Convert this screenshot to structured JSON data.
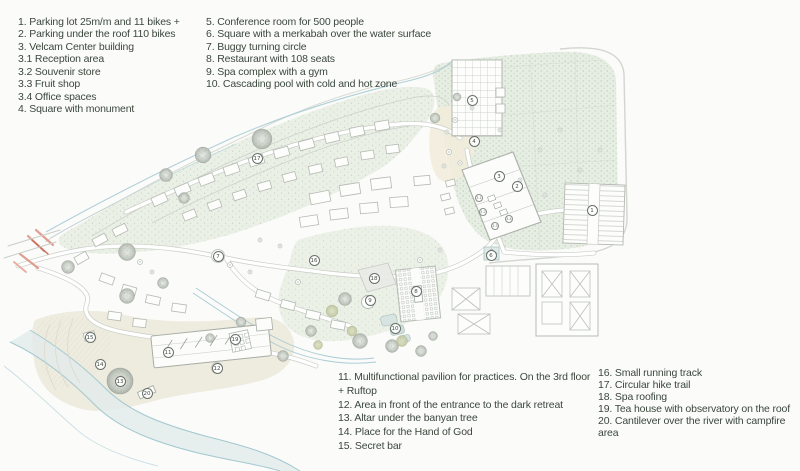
{
  "palette": {
    "background": "#fbfbfa",
    "legend_text": "#3b473c",
    "water": "#a8ccd4",
    "vegetation": "#e8eee4",
    "road_edge": "#c6cac2",
    "entrance_red": "#d98b7c",
    "marker_ring": "#69716a"
  },
  "legend": {
    "top_left": {
      "items": [
        "1. Parking lot 25m/m and 11 bikes +",
        "2. Parking under the roof 110 bikes",
        "3. Velcam Center building",
        "3.1 Reception area",
        "3.2 Souvenir store",
        "3.3 Fruit shop",
        "3.4 Office spaces",
        "4. Square with monument"
      ]
    },
    "top_middle": {
      "items": [
        "5. Conference room for 500 people",
        "6. Square with a merkabah over the water surface",
        "7. Buggy turning circle",
        "8. Restaurant with 108 seats",
        "9. Spa complex with a gym",
        "10. Cascading pool with cold and hot zone"
      ]
    },
    "bottom_middle": {
      "items": [
        "11. Multifunctional pavilion for practices. On the 3rd floor + Ruftop",
        "12. Area in front of the entrance to the dark retreat",
        "13. Altar under the banyan tree",
        "14. Place for the Hand of God",
        "15. Secret bar"
      ]
    },
    "bottom_right": {
      "items": [
        "16. Small running track",
        "17. Circular hike trail",
        "18. Spa roofing",
        "19. Tea house with observatory on the roof",
        "20. Cantilever over the river with campfire area"
      ]
    }
  },
  "map": {
    "markers": [
      {
        "n": "1",
        "x": 592,
        "y": 210
      },
      {
        "n": "2",
        "x": 517,
        "y": 186
      },
      {
        "n": "3",
        "x": 499,
        "y": 176
      },
      {
        "n": "4",
        "x": 474,
        "y": 141
      },
      {
        "n": "5",
        "x": 472,
        "y": 100
      },
      {
        "n": "6",
        "x": 491,
        "y": 255
      },
      {
        "n": "7",
        "x": 218,
        "y": 256
      },
      {
        "n": "8",
        "x": 416,
        "y": 291
      },
      {
        "n": "9",
        "x": 370,
        "y": 300
      },
      {
        "n": "10",
        "x": 395,
        "y": 328
      },
      {
        "n": "11",
        "x": 168,
        "y": 352
      },
      {
        "n": "12",
        "x": 217,
        "y": 368
      },
      {
        "n": "13",
        "x": 120,
        "y": 381
      },
      {
        "n": "14",
        "x": 100,
        "y": 364
      },
      {
        "n": "15",
        "x": 90,
        "y": 337
      },
      {
        "n": "16",
        "x": 314,
        "y": 260
      },
      {
        "n": "17",
        "x": 257,
        "y": 158
      },
      {
        "n": "18",
        "x": 374,
        "y": 278
      },
      {
        "n": "19",
        "x": 235,
        "y": 339
      },
      {
        "n": "20",
        "x": 147,
        "y": 393
      }
    ],
    "sub_markers": [
      {
        "n": "3.1",
        "x": 479,
        "y": 198
      },
      {
        "n": "3.2",
        "x": 483,
        "y": 212
      },
      {
        "n": "3.3",
        "x": 495,
        "y": 226
      },
      {
        "n": "3.4",
        "x": 509,
        "y": 219
      }
    ]
  }
}
